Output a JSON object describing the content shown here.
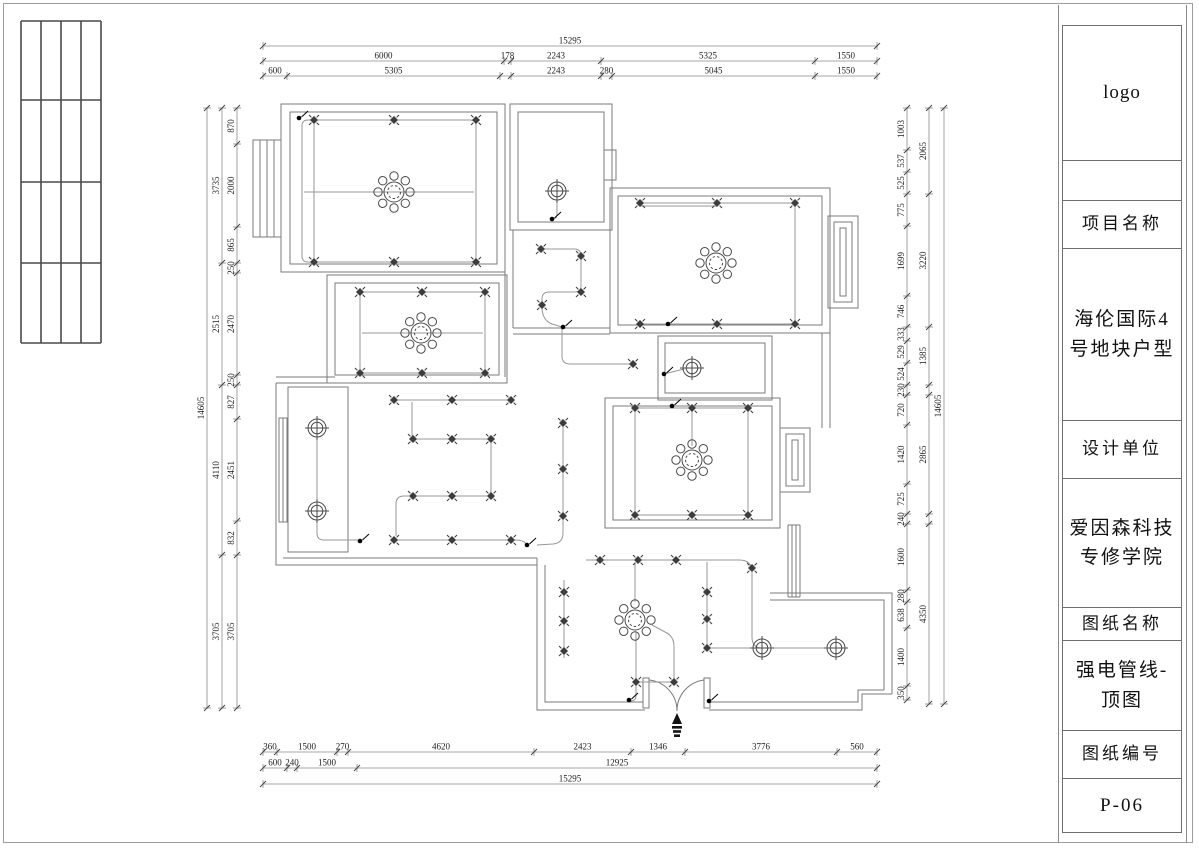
{
  "title_block": {
    "logo": "logo",
    "project_label": "项目名称",
    "project_name": "海伦国际4号地块户型",
    "designer_label": "设计单位",
    "designer_name": "爱因森科技专修学院",
    "drawing_label": "图纸名称",
    "drawing_name": "强电管线-顶图",
    "number_label": "图纸编号",
    "drawing_number": "P-06"
  },
  "dimensions": {
    "chains": [
      {
        "dir": "h",
        "axis": 46,
        "segs": [
          {
            "label": "15295",
            "from": 263,
            "to": 877
          }
        ]
      },
      {
        "dir": "h",
        "axis": 61,
        "segs": [
          {
            "label": "6000",
            "from": 263,
            "to": 504
          },
          {
            "label": "178",
            "from": 504,
            "to": 511
          },
          {
            "label": "2243",
            "from": 511,
            "to": 601
          },
          {
            "label": "5325",
            "from": 601,
            "to": 815
          },
          {
            "label": "1550",
            "from": 815,
            "to": 877
          }
        ]
      },
      {
        "dir": "h",
        "axis": 76,
        "segs": [
          {
            "label": "600",
            "from": 263,
            "to": 287
          },
          {
            "label": "5305",
            "from": 287,
            "to": 500
          },
          {
            "label": "",
            "from": 500,
            "to": 511
          },
          {
            "label": "2243",
            "from": 511,
            "to": 601
          },
          {
            "label": "280",
            "from": 601,
            "to": 612
          },
          {
            "label": "5045",
            "from": 612,
            "to": 815
          },
          {
            "label": "1550",
            "from": 815,
            "to": 877
          }
        ]
      },
      {
        "dir": "h",
        "axis": 752,
        "segs": [
          {
            "label": "360",
            "from": 263,
            "to": 277
          },
          {
            "label": "1500",
            "from": 277,
            "to": 337
          },
          {
            "label": "270",
            "from": 337,
            "to": 348
          },
          {
            "label": "4620",
            "from": 348,
            "to": 534
          },
          {
            "label": "2423",
            "from": 534,
            "to": 631
          },
          {
            "label": "1346",
            "from": 631,
            "to": 685
          },
          {
            "label": "3776",
            "from": 685,
            "to": 837
          },
          {
            "label": "560",
            "from": 837,
            "to": 877
          }
        ]
      },
      {
        "dir": "h",
        "axis": 768,
        "segs": [
          {
            "label": "600",
            "from": 263,
            "to": 287
          },
          {
            "label": "240",
            "from": 287,
            "to": 297
          },
          {
            "label": "1500",
            "from": 297,
            "to": 357
          },
          {
            "label": "12925",
            "from": 357,
            "to": 877
          }
        ]
      },
      {
        "dir": "h",
        "axis": 784,
        "segs": [
          {
            "label": "15295",
            "from": 263,
            "to": 877
          }
        ]
      },
      {
        "dir": "v",
        "axis": 207,
        "segs": [
          {
            "label": "14605",
            "from": 108,
            "to": 708
          }
        ]
      },
      {
        "dir": "v",
        "axis": 222,
        "segs": [
          {
            "label": "3735",
            "from": 108,
            "to": 263
          },
          {
            "label": "2515",
            "from": 263,
            "to": 385
          },
          {
            "label": "4110",
            "from": 385,
            "to": 555
          },
          {
            "label": "3705",
            "from": 555,
            "to": 708
          }
        ]
      },
      {
        "dir": "v",
        "axis": 237,
        "segs": [
          {
            "label": "870",
            "from": 108,
            "to": 144
          },
          {
            "label": "2000",
            "from": 144,
            "to": 227
          },
          {
            "label": "865",
            "from": 227,
            "to": 263
          },
          {
            "label": "250",
            "from": 263,
            "to": 273
          },
          {
            "label": "2470",
            "from": 273,
            "to": 375
          },
          {
            "label": "250",
            "from": 375,
            "to": 385
          },
          {
            "label": "827",
            "from": 385,
            "to": 419
          },
          {
            "label": "2451",
            "from": 419,
            "to": 521
          },
          {
            "label": "832",
            "from": 521,
            "to": 555
          },
          {
            "label": "3705",
            "from": 555,
            "to": 708
          }
        ]
      },
      {
        "dir": "v",
        "axis": 907,
        "segs": [
          {
            "label": "1003",
            "from": 108,
            "to": 150
          },
          {
            "label": "537",
            "from": 150,
            "to": 172
          },
          {
            "label": "525",
            "from": 172,
            "to": 194
          },
          {
            "label": "775",
            "from": 194,
            "to": 226
          },
          {
            "label": "1699",
            "from": 226,
            "to": 296
          },
          {
            "label": "746",
            "from": 296,
            "to": 327
          },
          {
            "label": "333",
            "from": 327,
            "to": 341
          },
          {
            "label": "529",
            "from": 341,
            "to": 363
          },
          {
            "label": "524",
            "from": 363,
            "to": 385
          },
          {
            "label": "230",
            "from": 385,
            "to": 395
          },
          {
            "label": "720",
            "from": 395,
            "to": 425
          },
          {
            "label": "1420",
            "from": 425,
            "to": 484
          },
          {
            "label": "725",
            "from": 484,
            "to": 514
          },
          {
            "label": "240",
            "from": 514,
            "to": 524
          },
          {
            "label": "1600",
            "from": 524,
            "to": 590
          },
          {
            "label": "280",
            "from": 590,
            "to": 602
          },
          {
            "label": "638",
            "from": 602,
            "to": 628
          },
          {
            "label": "1400",
            "from": 628,
            "to": 686
          },
          {
            "label": "350",
            "from": 686,
            "to": 700
          }
        ]
      },
      {
        "dir": "v",
        "axis": 929,
        "segs": [
          {
            "label": "2065",
            "from": 108,
            "to": 194
          },
          {
            "label": "3220",
            "from": 194,
            "to": 327
          },
          {
            "label": "1385",
            "from": 327,
            "to": 385
          },
          {
            "label": "",
            "from": 385,
            "to": 395
          },
          {
            "label": "2865",
            "from": 395,
            "to": 514
          },
          {
            "label": "",
            "from": 514,
            "to": 524
          },
          {
            "label": "4350",
            "from": 524,
            "to": 704
          }
        ]
      },
      {
        "dir": "v",
        "axis": 944,
        "segs": [
          {
            "label": "14605",
            "from": 108,
            "to": 704
          }
        ]
      }
    ]
  },
  "fixtures": {
    "chandeliers": [
      [
        394,
        192
      ],
      [
        421,
        333
      ],
      [
        716,
        263
      ],
      [
        692,
        460
      ],
      [
        635,
        620
      ]
    ],
    "ceiling_lights": [
      [
        557,
        191
      ],
      [
        692,
        368
      ],
      [
        317,
        428
      ],
      [
        317,
        511
      ],
      [
        762,
        648
      ],
      [
        836,
        648
      ]
    ],
    "spots": [
      [
        314,
        120
      ],
      [
        394,
        120
      ],
      [
        476,
        120
      ],
      [
        314,
        262
      ],
      [
        394,
        262
      ],
      [
        476,
        262
      ],
      [
        640,
        203
      ],
      [
        717,
        203
      ],
      [
        795,
        203
      ],
      [
        640,
        324
      ],
      [
        717,
        324
      ],
      [
        795,
        324
      ],
      [
        360,
        292
      ],
      [
        422,
        292
      ],
      [
        485,
        292
      ],
      [
        360,
        373
      ],
      [
        422,
        373
      ],
      [
        485,
        373
      ],
      [
        541,
        249
      ],
      [
        581,
        256
      ],
      [
        581,
        292
      ],
      [
        542,
        305
      ],
      [
        633,
        364
      ],
      [
        635,
        408
      ],
      [
        692,
        408
      ],
      [
        748,
        408
      ],
      [
        635,
        515
      ],
      [
        692,
        515
      ],
      [
        748,
        515
      ],
      [
        394,
        400
      ],
      [
        452,
        400
      ],
      [
        511,
        400
      ],
      [
        413,
        439
      ],
      [
        452,
        439
      ],
      [
        491,
        439
      ],
      [
        413,
        496
      ],
      [
        452,
        496
      ],
      [
        491,
        496
      ],
      [
        394,
        540
      ],
      [
        452,
        540
      ],
      [
        511,
        540
      ],
      [
        563,
        423
      ],
      [
        563,
        469
      ],
      [
        563,
        516
      ],
      [
        600,
        560
      ],
      [
        638,
        560
      ],
      [
        676,
        560
      ],
      [
        752,
        568
      ],
      [
        707,
        592
      ],
      [
        707,
        619
      ],
      [
        707,
        648
      ],
      [
        564,
        592
      ],
      [
        564,
        621
      ],
      [
        564,
        651
      ],
      [
        636,
        682
      ],
      [
        674,
        682
      ]
    ],
    "junctions": [
      [
        299,
        118
      ],
      [
        552,
        219
      ],
      [
        668,
        324
      ],
      [
        563,
        327
      ],
      [
        664,
        374
      ],
      [
        672,
        406
      ],
      [
        360,
        541
      ],
      [
        527,
        545
      ],
      [
        629,
        700
      ],
      [
        709,
        701
      ]
    ],
    "north_arrow": [
      677,
      724
    ]
  }
}
